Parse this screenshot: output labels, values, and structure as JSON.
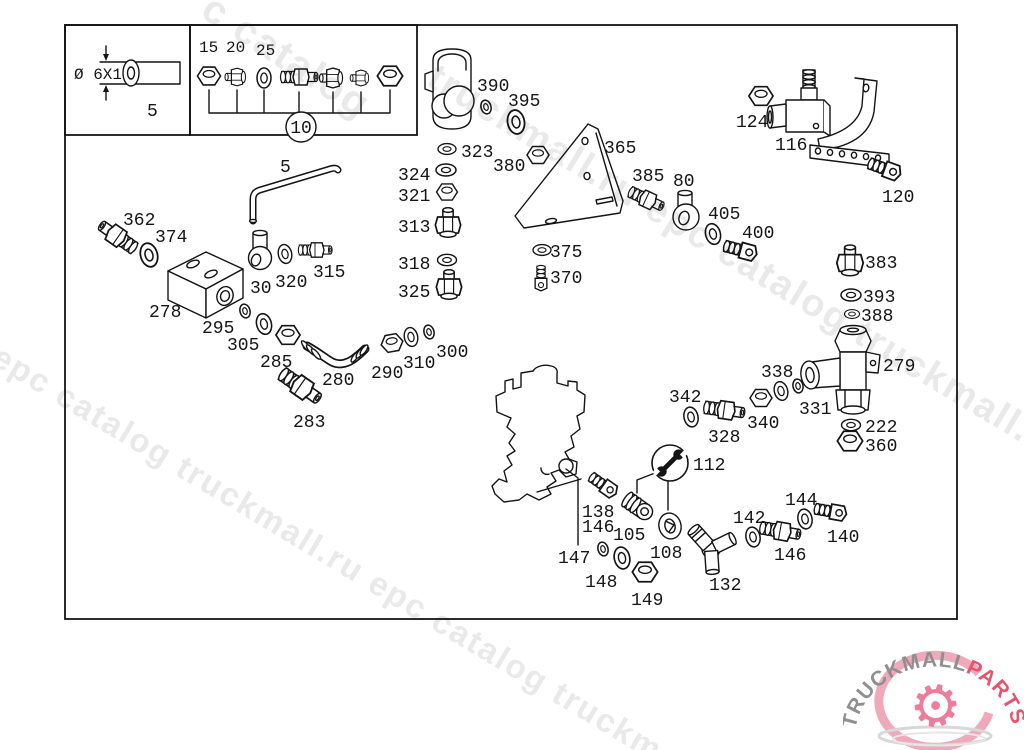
{
  "watermark": {
    "color": "#e9e9e9",
    "angle_deg": 31,
    "fragments": [
      "c catalog",
      "truckmall.ru epc catalog truckmall.ru epc",
      "l epc catalog truckmall.ru epc catalog truckm"
    ]
  },
  "logo": {
    "text_gray": "TRUCKMALL",
    "text_accent": "PARTS",
    "gray": "#8f8f8f",
    "accent": "#e8536e",
    "gear_color": "#ee7d9c",
    "gear_icon": "gear-icon"
  },
  "inset": {
    "dim_label": "Ø 6X1",
    "length_label": "5"
  },
  "fitting_group": {
    "item_labels": [
      "15",
      "20",
      "25"
    ],
    "group_number": "10"
  },
  "parts": [
    {
      "label": "390",
      "type": "o-ring"
    },
    {
      "label": "395",
      "type": "o-ring"
    },
    {
      "label": "323",
      "type": "washer"
    },
    {
      "label": "380",
      "type": "nut"
    },
    {
      "label": "365",
      "type": "mounting-bracket"
    },
    {
      "label": "324",
      "type": "washer"
    },
    {
      "label": "321",
      "type": "nut"
    },
    {
      "label": "313",
      "type": "plug-fitting"
    },
    {
      "label": "318",
      "type": "washer"
    },
    {
      "label": "325",
      "type": "plug-fitting"
    },
    {
      "label": "375",
      "type": "washer"
    },
    {
      "label": "370",
      "type": "screw"
    },
    {
      "label": "385",
      "type": "union-fitting"
    },
    {
      "label": "80",
      "type": "banjo-fitting"
    },
    {
      "label": "405",
      "type": "seal-ring"
    },
    {
      "label": "400",
      "type": "hollow-screw"
    },
    {
      "label": "124",
      "type": "nut"
    },
    {
      "label": "116",
      "type": "valve"
    },
    {
      "label": "120",
      "type": "screw"
    },
    {
      "label": "383",
      "type": "plug-fitting"
    },
    {
      "label": "393",
      "type": "washer"
    },
    {
      "label": "388",
      "type": "seal-ring"
    },
    {
      "label": "279",
      "type": "valve-body"
    },
    {
      "label": "331",
      "type": "o-ring"
    },
    {
      "label": "222",
      "type": "washer"
    },
    {
      "label": "360",
      "type": "nut"
    },
    {
      "label": "338",
      "type": "o-ring"
    },
    {
      "label": "342",
      "type": "o-ring"
    },
    {
      "label": "328",
      "type": "union-fitting"
    },
    {
      "label": "340",
      "type": "nut"
    },
    {
      "label": "362",
      "type": "union-fitting"
    },
    {
      "label": "374",
      "type": "o-ring"
    },
    {
      "label": "278",
      "type": "junction-block"
    },
    {
      "label": "5",
      "type": "bent-pipe"
    },
    {
      "label": "30",
      "type": "elbow-fitting"
    },
    {
      "label": "320",
      "type": "o-ring"
    },
    {
      "label": "315",
      "type": "union-fitting"
    },
    {
      "label": "295",
      "type": "o-ring"
    },
    {
      "label": "305",
      "type": "o-ring"
    },
    {
      "label": "285",
      "type": "cap-nut"
    },
    {
      "label": "280",
      "type": "hose"
    },
    {
      "label": "290",
      "type": "cap-nut"
    },
    {
      "label": "310",
      "type": "o-ring"
    },
    {
      "label": "300",
      "type": "o-ring"
    },
    {
      "label": "283",
      "type": "union-fitting"
    },
    {
      "label": "112",
      "type": "wrench-symbol"
    },
    {
      "label": "138",
      "type": "fitting"
    },
    {
      "label": "146",
      "type": "fitting"
    },
    {
      "label": "105",
      "type": "plug"
    },
    {
      "label": "108",
      "type": "ring-fitting"
    },
    {
      "label": "147",
      "type": "seal-ring"
    },
    {
      "label": "148",
      "type": "o-ring"
    },
    {
      "label": "149",
      "type": "nut"
    },
    {
      "label": "132",
      "type": "y-fitting"
    },
    {
      "label": "142",
      "type": "seal-ring"
    },
    {
      "label": "146",
      "type": "union-fitting"
    },
    {
      "label": "144",
      "type": "seal-ring"
    },
    {
      "label": "140",
      "type": "hollow-screw"
    }
  ]
}
